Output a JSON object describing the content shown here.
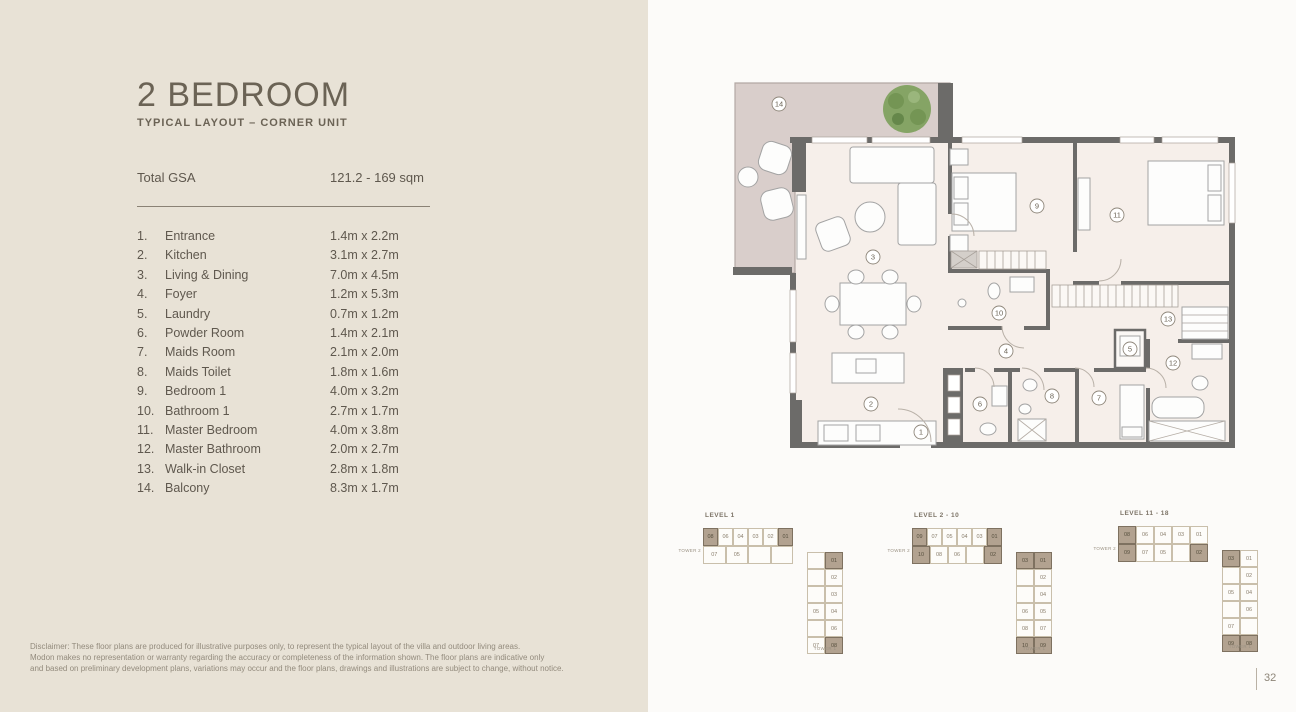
{
  "header": {
    "title": "2 BEDROOM",
    "subtitle": "TYPICAL LAYOUT – CORNER UNIT"
  },
  "gsa": {
    "label": "Total GSA",
    "value": "121.2 - 169 sqm"
  },
  "room_list": {
    "items": [
      {
        "num": "1.",
        "name": "Entrance",
        "dims": "1.4m x 2.2m"
      },
      {
        "num": "2.",
        "name": "Kitchen",
        "dims": "3.1m x 2.7m"
      },
      {
        "num": "3.",
        "name": "Living & Dining",
        "dims": "7.0m x 4.5m"
      },
      {
        "num": "4.",
        "name": "Foyer",
        "dims": "1.2m x 5.3m"
      },
      {
        "num": "5.",
        "name": "Laundry",
        "dims": "0.7m x 1.2m"
      },
      {
        "num": "6.",
        "name": "Powder Room",
        "dims": "1.4m x 2.1m"
      },
      {
        "num": "7.",
        "name": "Maids Room",
        "dims": "2.1m x 2.0m"
      },
      {
        "num": "8.",
        "name": "Maids Toilet",
        "dims": "1.8m x 1.6m"
      },
      {
        "num": "9.",
        "name": "Bedroom 1",
        "dims": "4.0m x 3.2m"
      },
      {
        "num": "10.",
        "name": "Bathroom 1",
        "dims": "2.7m x 1.7m"
      },
      {
        "num": "11.",
        "name": "Master Bedroom",
        "dims": "4.0m x 3.8m"
      },
      {
        "num": "12.",
        "name": "Master Bathroom",
        "dims": "2.0m x 2.7m"
      },
      {
        "num": "13.",
        "name": "Walk-in Closet",
        "dims": "2.8m x 1.8m"
      },
      {
        "num": "14.",
        "name": "Balcony",
        "dims": "8.3m x 1.7m"
      }
    ]
  },
  "disclaimer": {
    "lines": [
      "Disclaimer: These floor plans are produced for illustrative purposes only, to represent the typical layout of the villa and outdoor living areas.",
      "Modon makes no representation or warranty regarding the accuracy or completeness of the information shown. The floor plans are indicative only",
      "and based on preliminary development plans, variations may occur and the floor plans, drawings and illustrations are subject to change, without notice."
    ]
  },
  "floor_plan": {
    "markers": [
      {
        "n": "1",
        "x": 221,
        "y": 377
      },
      {
        "n": "2",
        "x": 171,
        "y": 349
      },
      {
        "n": "3",
        "x": 173,
        "y": 202
      },
      {
        "n": "4",
        "x": 306,
        "y": 296
      },
      {
        "n": "5",
        "x": 430,
        "y": 294
      },
      {
        "n": "6",
        "x": 280,
        "y": 349
      },
      {
        "n": "7",
        "x": 399,
        "y": 343
      },
      {
        "n": "8",
        "x": 352,
        "y": 341
      },
      {
        "n": "9",
        "x": 337,
        "y": 151
      },
      {
        "n": "10",
        "x": 299,
        "y": 258
      },
      {
        "n": "11",
        "x": 417,
        "y": 160
      },
      {
        "n": "12",
        "x": 473,
        "y": 308
      },
      {
        "n": "13",
        "x": 468,
        "y": 264
      },
      {
        "n": "14",
        "x": 79,
        "y": 49
      }
    ]
  },
  "levels": [
    {
      "label": "LEVEL 1",
      "tower_h_label": "TOWER 2",
      "tower_v_label": "TOWER 1",
      "h_rows": [
        [
          {
            "u": "08",
            "hl": true
          },
          {
            "u": "06"
          },
          {
            "u": "04"
          },
          {
            "u": "03"
          },
          {
            "u": "02"
          },
          {
            "u": "01",
            "hl": true
          }
        ],
        [
          {
            "u": "07"
          },
          {
            "u": "05"
          },
          {
            "u": ""
          },
          {
            "u": ""
          }
        ]
      ],
      "v_rows": [
        [
          {
            "u": ""
          },
          {
            "u": "01",
            "hl": true
          }
        ],
        [
          {
            "u": ""
          },
          {
            "u": "02"
          }
        ],
        [
          {
            "u": ""
          },
          {
            "u": "03"
          }
        ],
        [
          {
            "u": "05"
          },
          {
            "u": "04"
          }
        ],
        [
          {
            "u": ""
          },
          {
            "u": "06"
          }
        ],
        [
          {
            "u": "07"
          },
          {
            "u": "08",
            "hl": true
          }
        ]
      ]
    },
    {
      "label": "LEVEL 2 - 10",
      "tower_h_label": "TOWER 2",
      "tower_v_label": "TOWER 1",
      "h_rows": [
        [
          {
            "u": "09",
            "hl": true
          },
          {
            "u": "07"
          },
          {
            "u": "05"
          },
          {
            "u": "04"
          },
          {
            "u": "03"
          },
          {
            "u": "01",
            "hl": true
          }
        ],
        [
          {
            "u": "10",
            "hl": true
          },
          {
            "u": "08"
          },
          {
            "u": "06"
          },
          {
            "u": ""
          },
          {
            "u": "02",
            "hl": true
          }
        ]
      ],
      "v_rows": [
        [
          {
            "u": "03",
            "hl": true
          },
          {
            "u": "01",
            "hl": true
          }
        ],
        [
          {
            "u": ""
          },
          {
            "u": "02"
          }
        ],
        [
          {
            "u": ""
          },
          {
            "u": "04"
          }
        ],
        [
          {
            "u": "06"
          },
          {
            "u": "05"
          }
        ],
        [
          {
            "u": "08"
          },
          {
            "u": "07"
          }
        ],
        [
          {
            "u": "10",
            "hl": true
          },
          {
            "u": "09",
            "hl": true
          }
        ]
      ]
    },
    {
      "label": "LEVEL 11 - 18",
      "tower_h_label": "TOWER 2",
      "tower_v_label": "TOWER 1",
      "h_rows": [
        [
          {
            "u": "08",
            "hl": true
          },
          {
            "u": "06"
          },
          {
            "u": "04"
          },
          {
            "u": "03"
          },
          {
            "u": "01"
          }
        ],
        [
          {
            "u": "09",
            "hl": true
          },
          {
            "u": "07"
          },
          {
            "u": "05"
          },
          {
            "u": ""
          },
          {
            "u": "02",
            "hl": true
          }
        ]
      ],
      "v_rows": [
        [
          {
            "u": "03",
            "hl": true
          },
          {
            "u": "01"
          }
        ],
        [
          {
            "u": ""
          },
          {
            "u": "02"
          }
        ],
        [
          {
            "u": "05"
          },
          {
            "u": "04"
          }
        ],
        [
          {
            "u": ""
          },
          {
            "u": "06"
          }
        ],
        [
          {
            "u": "07"
          },
          {
            "u": ""
          }
        ],
        [
          {
            "u": "09",
            "hl": true
          },
          {
            "u": "08",
            "hl": true
          }
        ]
      ]
    }
  ],
  "footer": {
    "page_number": "32"
  },
  "colors": {
    "panel_bg": "#e8e2d6",
    "page_bg": "#fcfbf9",
    "wall": "#6c6b69",
    "floor": "#f6efea",
    "balcony": "#d9cecb",
    "unit_highlight": "#b2a290",
    "text_dark": "#6b6355",
    "text_body": "#5f584e",
    "text_muted": "#938b7d",
    "tree": "#85a465"
  }
}
